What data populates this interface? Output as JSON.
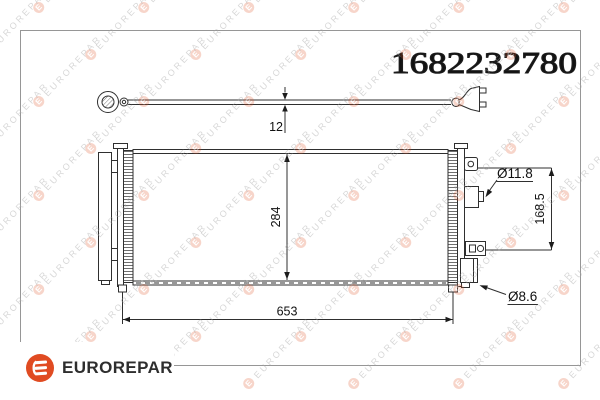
{
  "part_number": "1682232780",
  "brand": {
    "name": "EUROREPAR"
  },
  "watermark": {
    "text": "EUROREPAR"
  },
  "dimensions": {
    "pipe_diameter": "12",
    "core_height": "284",
    "core_width": "653",
    "upper_port_diameter": "Ø11.8",
    "port_spacing": "168.5",
    "lower_port_diameter": "Ø8.6"
  },
  "colors": {
    "accent": "#e04b22",
    "line": "#2f2f2f",
    "frame": "#969696",
    "watermark_gray": "#a8a8a8"
  }
}
